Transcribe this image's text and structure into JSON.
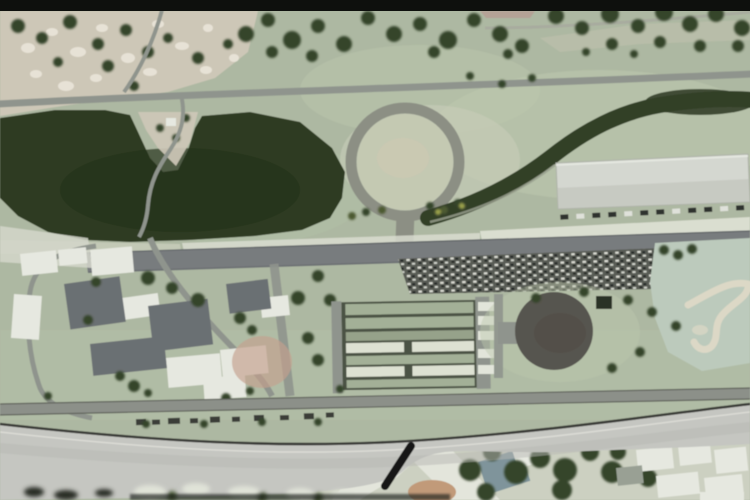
{
  "meta": {
    "kind": "aerial-satellite-video-frame",
    "subject": "letterboxed aerial view of an automotive proving ground with circular test ring, skid pad, lake, workshop complex and a wide foreground highway",
    "visible_text": "none"
  },
  "palette": {
    "letterbox": "#0e100d",
    "grass_base": "#adb8a2",
    "grass_light": "#bdc8ae",
    "village_sand": "#cdc7b7",
    "sand_light": "#e7e2d6",
    "lake": "#2d3b21",
    "lake_shade": "#26321b",
    "road": "#8f948d",
    "road_dark": "#787c7e",
    "ring": "#8c8f84",
    "ring_infield": "#c4c9b2",
    "curve_band": "#333f28",
    "warehouse": "#d4d7d0",
    "apron": "#dcdfd3",
    "parking": "#54574f",
    "parking_blob": "#3b3f3c",
    "pad": "#57554f",
    "pond": "#bccabc",
    "pond_sand": "#ddd8c6",
    "flyover": "#c5c6c1",
    "flyover_edge": "#2a2b28",
    "flyover_curb": "#ecece6",
    "building_white": "#e6e8e0",
    "building_gray": "#6b7073",
    "shed_green": "#a3b097",
    "shed_white": "#dde1d2",
    "shed_shadow": "#4c5244",
    "salmon_roof": "#c49f8e",
    "tree": "#35442a",
    "junction_white": "#e3e5db",
    "district_ground": "#ccd0c1",
    "blue_roof": "#7f949b",
    "tan_patch": "#c19a79",
    "dark_slash": "#141614",
    "bottom_smear": "#1e211e"
  },
  "features": {
    "village": "sandy settlement area top-left",
    "lake": "dark reservoir lake",
    "ring_track": "circular test ring",
    "banked_curve": "dark tree-lined sweeping curve",
    "warehouse": "large light workshop hall",
    "main_straight": "main test straight",
    "parking_lot": "vehicle park full of cars",
    "shed_rows": "rows of long striped sheds",
    "skid_pad": "dark circular skid pad",
    "pond": "pale shallow pond with sand bars",
    "facility": "office and workshop complex",
    "lower_straight": "secondary straight road",
    "flyover": "wide foreground highway sweep",
    "junction": "light road junction below flyover",
    "district": "buildings beside the highway"
  }
}
